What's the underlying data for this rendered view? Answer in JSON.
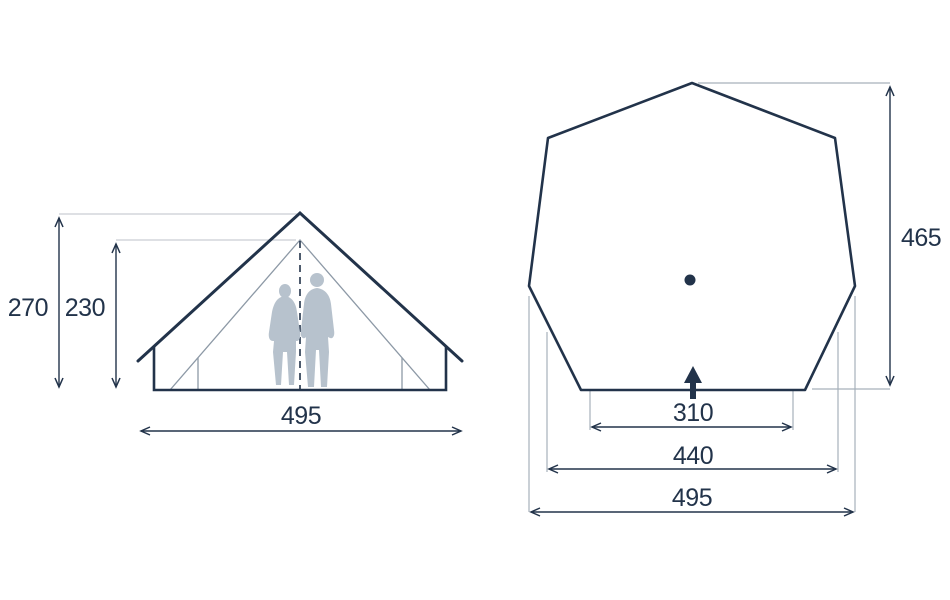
{
  "diagram_title": "tent-dimension-drawing",
  "front_view": {
    "outer_height": "270",
    "inner_height": "230",
    "base_width": "495"
  },
  "plan_view": {
    "depth": "465",
    "door_width": "310",
    "mid_width": "440",
    "max_width": "495"
  },
  "colors": {
    "line_dark": "#22334a",
    "line_light": "#c9ced4",
    "line_plan_extension": "#a6b0ba",
    "line_inner": "#8d99a6",
    "silhouette": "#b7c2cd",
    "background": "#ffffff"
  }
}
